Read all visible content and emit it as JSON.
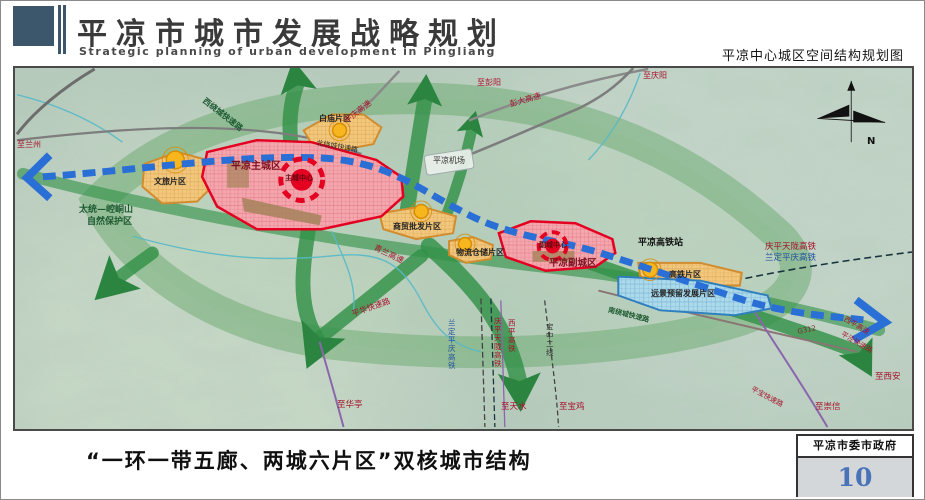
{
  "header": {
    "title": "平凉市城市发展战略规划",
    "subtitle_en": "Strategic planning of urban development in Pingliang",
    "map_title": "平凉中心城区空间结构规划图"
  },
  "map": {
    "compass_n": "N",
    "labels": [
      {
        "text": "至兰州"
      },
      {
        "text": "太统—崆峒山"
      },
      {
        "text": "自然保护区"
      },
      {
        "text": "文旅片区"
      },
      {
        "text": "平凉主城区"
      },
      {
        "text": "主城中心"
      },
      {
        "text": "白庙片区"
      },
      {
        "text": "西绕城快速路"
      },
      {
        "text": "平庆高速"
      },
      {
        "text": "至彭阳"
      },
      {
        "text": "彭大高速"
      },
      {
        "text": "至庆阳"
      },
      {
        "text": "北绕城快速路"
      },
      {
        "text": "平凉机场"
      },
      {
        "text": "青兰高速"
      },
      {
        "text": "商贸批发片区"
      },
      {
        "text": "物流仓储片区"
      },
      {
        "text": "平凉副城区"
      },
      {
        "text": "副城中心"
      },
      {
        "text": "平凉高铁站"
      },
      {
        "text": "庆平天陇高铁"
      },
      {
        "text": "兰定平庆高铁"
      },
      {
        "text": "高铁片区"
      },
      {
        "text": "远景预留发展片区"
      },
      {
        "text": "南绕城快速路"
      },
      {
        "text": "平华快速路"
      },
      {
        "text": "至华亭"
      },
      {
        "text": "兰定平庆高铁"
      },
      {
        "text": "庆平天陇高铁"
      },
      {
        "text": "西平高铁"
      },
      {
        "text": "宝中二线"
      },
      {
        "text": "至天水"
      },
      {
        "text": "至宝鸡"
      },
      {
        "text": "G312"
      },
      {
        "text": "西平高速"
      },
      {
        "text": "平泾快速路"
      },
      {
        "text": "平宝快速路"
      },
      {
        "text": "至崇信"
      },
      {
        "text": "至西安"
      }
    ]
  },
  "footer": {
    "caption": "“一环一带五廊、两城六片区”双核城市结构",
    "org": "平凉市委市政府",
    "page_no": "10"
  },
  "colors": {
    "accent_red": "#e30021",
    "belt_blue": "#2a6fd6",
    "corridor_green": "#2f9045",
    "terrain_green": "#b7ccbd",
    "zone_pink": "#f3a7ae",
    "zone_orange": "#f2c87e",
    "zone_blue": "#abdaea",
    "header_slate": "#3c566c"
  }
}
